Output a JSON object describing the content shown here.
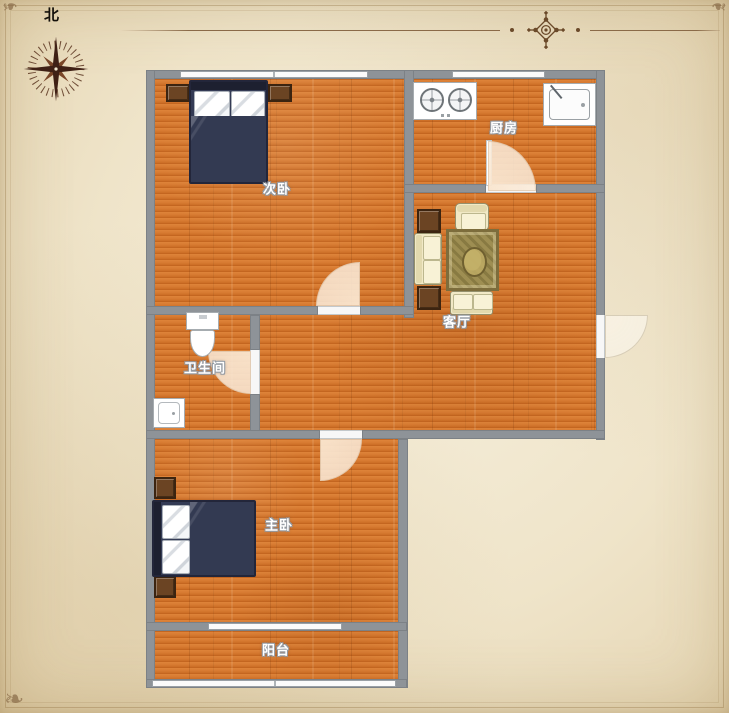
{
  "compass": {
    "north_label": "北"
  },
  "header_ornament": {
    "style": "floral-diamond divider",
    "color": "#6b4a2a"
  },
  "rooms": {
    "secondary_bedroom": {
      "label": "次卧"
    },
    "kitchen": {
      "label": "厨房"
    },
    "living_room": {
      "label": "客厅"
    },
    "bathroom": {
      "label": "卫生间"
    },
    "master_bedroom": {
      "label": "主卧"
    },
    "balcony": {
      "label": "阳台"
    }
  },
  "fixtures": {
    "secondary_bedroom": [
      "double-bed",
      "nightstand",
      "nightstand",
      "window"
    ],
    "kitchen": [
      "two-burner-stove",
      "sink",
      "door",
      "window"
    ],
    "living_room": [
      "sofa",
      "armchair",
      "loveseat",
      "rug",
      "side-table",
      "side-table",
      "entry-door"
    ],
    "bathroom": [
      "toilet",
      "wash-basin",
      "door"
    ],
    "master_bedroom": [
      "double-bed",
      "nightstand",
      "nightstand",
      "door"
    ],
    "balcony": [
      "window-band"
    ]
  },
  "colors": {
    "parchment_bg": "#efe4c9",
    "wall": "#8e9398",
    "floor_wood": "#d4772e",
    "door_arc": "#f8e3cb",
    "bed_duvet": "#333a52",
    "furniture_wood": "#6b4423",
    "sofa_cream": "#f1e9c6",
    "rug_gold": "#9e8e52",
    "ornament_brown": "#6b4a2a",
    "label_text": "#ffffff"
  }
}
